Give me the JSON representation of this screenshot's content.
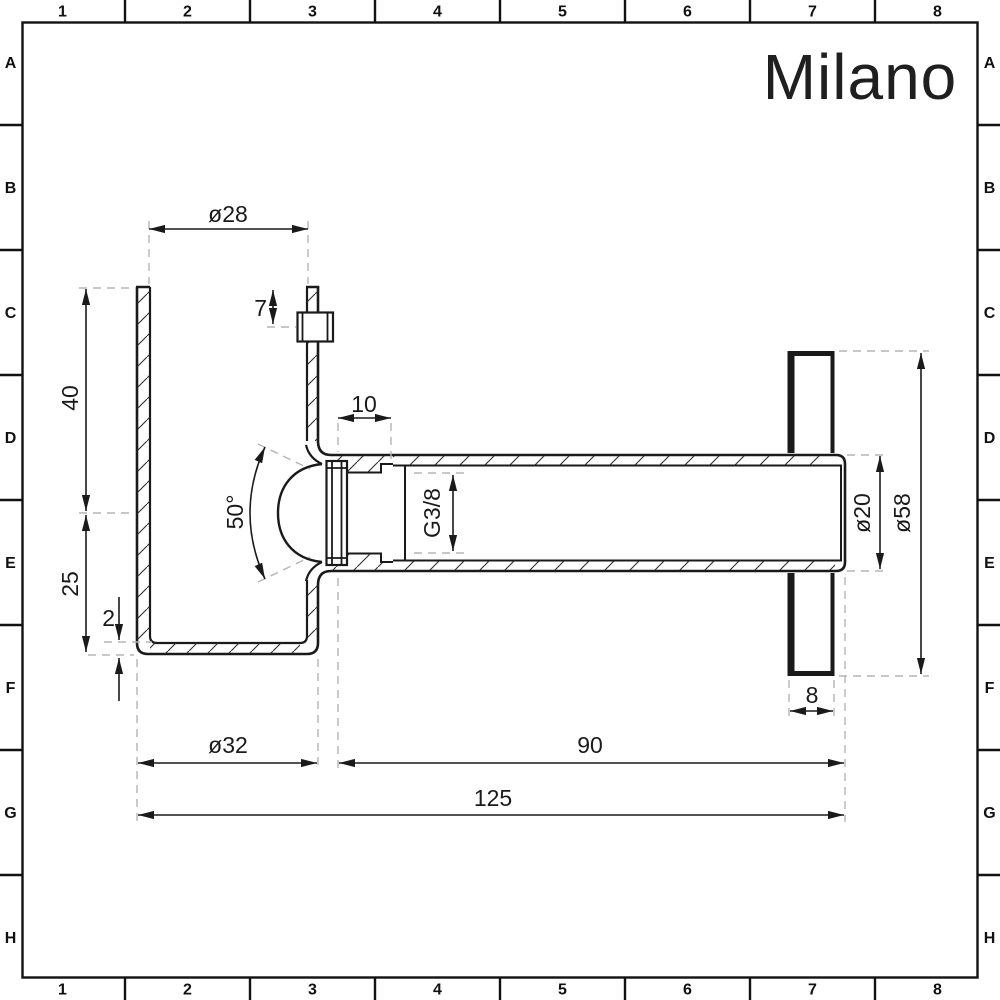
{
  "sheet": {
    "logo": "Milano",
    "grid_columns": [
      "1",
      "2",
      "3",
      "4",
      "5",
      "6",
      "7",
      "8"
    ],
    "grid_rows": [
      "A",
      "B",
      "C",
      "D",
      "E",
      "F",
      "G",
      "H"
    ]
  },
  "drawing": {
    "dimensions": {
      "inlet_diameter": "ø28",
      "pin_offset": "7",
      "thread_depth": "10",
      "upper_height": "40",
      "lower_height": "25",
      "wall_thickness": "2",
      "seat_angle": "50°",
      "thread_size": "G3/8",
      "body_diameter": "ø32",
      "pipe_length": "90",
      "overall_length": "125",
      "pipe_diameter": "ø20",
      "flange_diameter": "ø58",
      "flange_thickness": "8"
    },
    "colors": {
      "line": "#1a1a1a",
      "dashed_line": "#b5b5b5",
      "background": "#ffffff"
    }
  }
}
